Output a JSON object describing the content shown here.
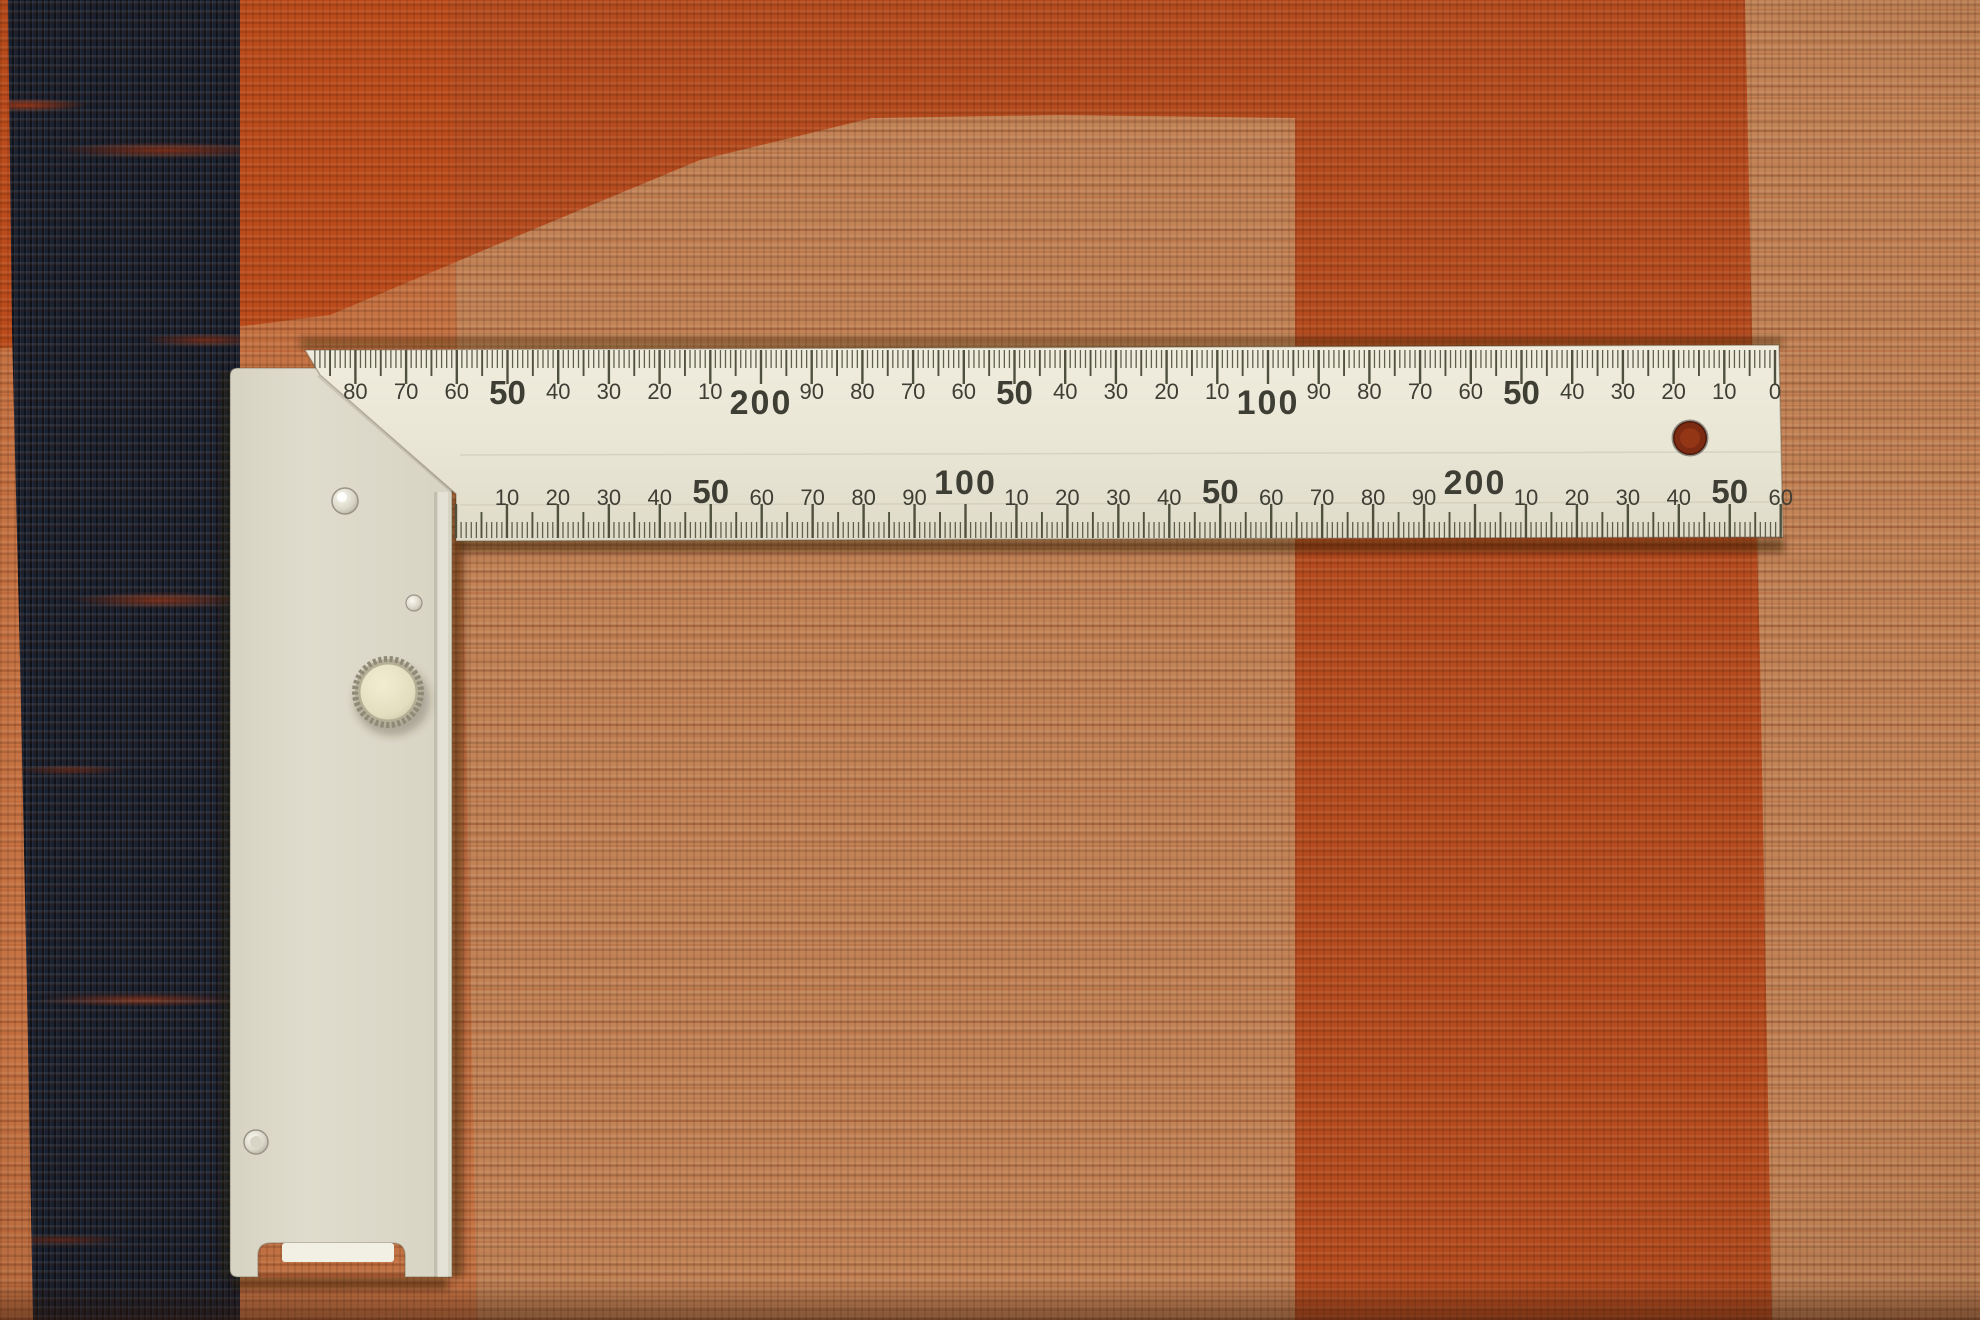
{
  "rug": {
    "colors": {
      "tan_field": "#c28457",
      "orange_top_band": "#b54b1e",
      "orange_right_band": "#c4511f",
      "navy_stripe": "#1a2130",
      "rust_streaks": "#96341a",
      "bottom_shadow": "#32160a"
    }
  },
  "square": {
    "colors": {
      "blade": "#ebe8d9",
      "handle": "#dcd8c9",
      "tick": "#50503f",
      "text": "#3e3e34",
      "knob_face": "#ece6ca",
      "hole_backing": "#7c2a12"
    },
    "top_scale": {
      "labels": [
        {
          "mm": 0,
          "t": "0",
          "size": "s"
        },
        {
          "mm": 10,
          "t": "10",
          "size": "s"
        },
        {
          "mm": 20,
          "t": "20",
          "size": "s"
        },
        {
          "mm": 30,
          "t": "30",
          "size": "s"
        },
        {
          "mm": 40,
          "t": "40",
          "size": "s"
        },
        {
          "mm": 50,
          "t": "50",
          "size": "b"
        },
        {
          "mm": 60,
          "t": "60",
          "size": "s"
        },
        {
          "mm": 70,
          "t": "70",
          "size": "s"
        },
        {
          "mm": 80,
          "t": "80",
          "size": "s"
        },
        {
          "mm": 90,
          "t": "90",
          "size": "s"
        },
        {
          "mm": 100,
          "t": "100",
          "size": "h"
        },
        {
          "mm": 110,
          "t": "10",
          "size": "s"
        },
        {
          "mm": 120,
          "t": "20",
          "size": "s"
        },
        {
          "mm": 130,
          "t": "30",
          "size": "s"
        },
        {
          "mm": 140,
          "t": "40",
          "size": "s"
        },
        {
          "mm": 150,
          "t": "50",
          "size": "b"
        },
        {
          "mm": 160,
          "t": "60",
          "size": "s"
        },
        {
          "mm": 170,
          "t": "70",
          "size": "s"
        },
        {
          "mm": 180,
          "t": "80",
          "size": "s"
        },
        {
          "mm": 190,
          "t": "90",
          "size": "s"
        },
        {
          "mm": 200,
          "t": "200",
          "size": "h"
        },
        {
          "mm": 210,
          "t": "10",
          "size": "s"
        },
        {
          "mm": 220,
          "t": "20",
          "size": "s"
        },
        {
          "mm": 230,
          "t": "30",
          "size": "s"
        },
        {
          "mm": 240,
          "t": "40",
          "size": "s"
        },
        {
          "mm": 250,
          "t": "50",
          "size": "b"
        },
        {
          "mm": 260,
          "t": "60",
          "size": "s"
        },
        {
          "mm": 270,
          "t": "70",
          "size": "s"
        },
        {
          "mm": 280,
          "t": "80",
          "size": "s"
        }
      ]
    },
    "bottom_scale": {
      "labels": [
        {
          "mm": 10,
          "t": "10",
          "size": "s"
        },
        {
          "mm": 20,
          "t": "20",
          "size": "s"
        },
        {
          "mm": 30,
          "t": "30",
          "size": "s"
        },
        {
          "mm": 40,
          "t": "40",
          "size": "s"
        },
        {
          "mm": 50,
          "t": "50",
          "size": "b"
        },
        {
          "mm": 60,
          "t": "60",
          "size": "s"
        },
        {
          "mm": 70,
          "t": "70",
          "size": "s"
        },
        {
          "mm": 80,
          "t": "80",
          "size": "s"
        },
        {
          "mm": 90,
          "t": "90",
          "size": "s"
        },
        {
          "mm": 100,
          "t": "100",
          "size": "h"
        },
        {
          "mm": 110,
          "t": "10",
          "size": "s"
        },
        {
          "mm": 120,
          "t": "20",
          "size": "s"
        },
        {
          "mm": 130,
          "t": "30",
          "size": "s"
        },
        {
          "mm": 140,
          "t": "40",
          "size": "s"
        },
        {
          "mm": 150,
          "t": "50",
          "size": "b"
        },
        {
          "mm": 160,
          "t": "60",
          "size": "s"
        },
        {
          "mm": 170,
          "t": "70",
          "size": "s"
        },
        {
          "mm": 180,
          "t": "80",
          "size": "s"
        },
        {
          "mm": 190,
          "t": "90",
          "size": "s"
        },
        {
          "mm": 200,
          "t": "200",
          "size": "h"
        },
        {
          "mm": 210,
          "t": "10",
          "size": "s"
        },
        {
          "mm": 220,
          "t": "20",
          "size": "s"
        },
        {
          "mm": 230,
          "t": "30",
          "size": "s"
        },
        {
          "mm": 240,
          "t": "40",
          "size": "s"
        },
        {
          "mm": 250,
          "t": "50",
          "size": "b"
        },
        {
          "mm": 260,
          "t": "60",
          "size": "s"
        }
      ]
    }
  }
}
